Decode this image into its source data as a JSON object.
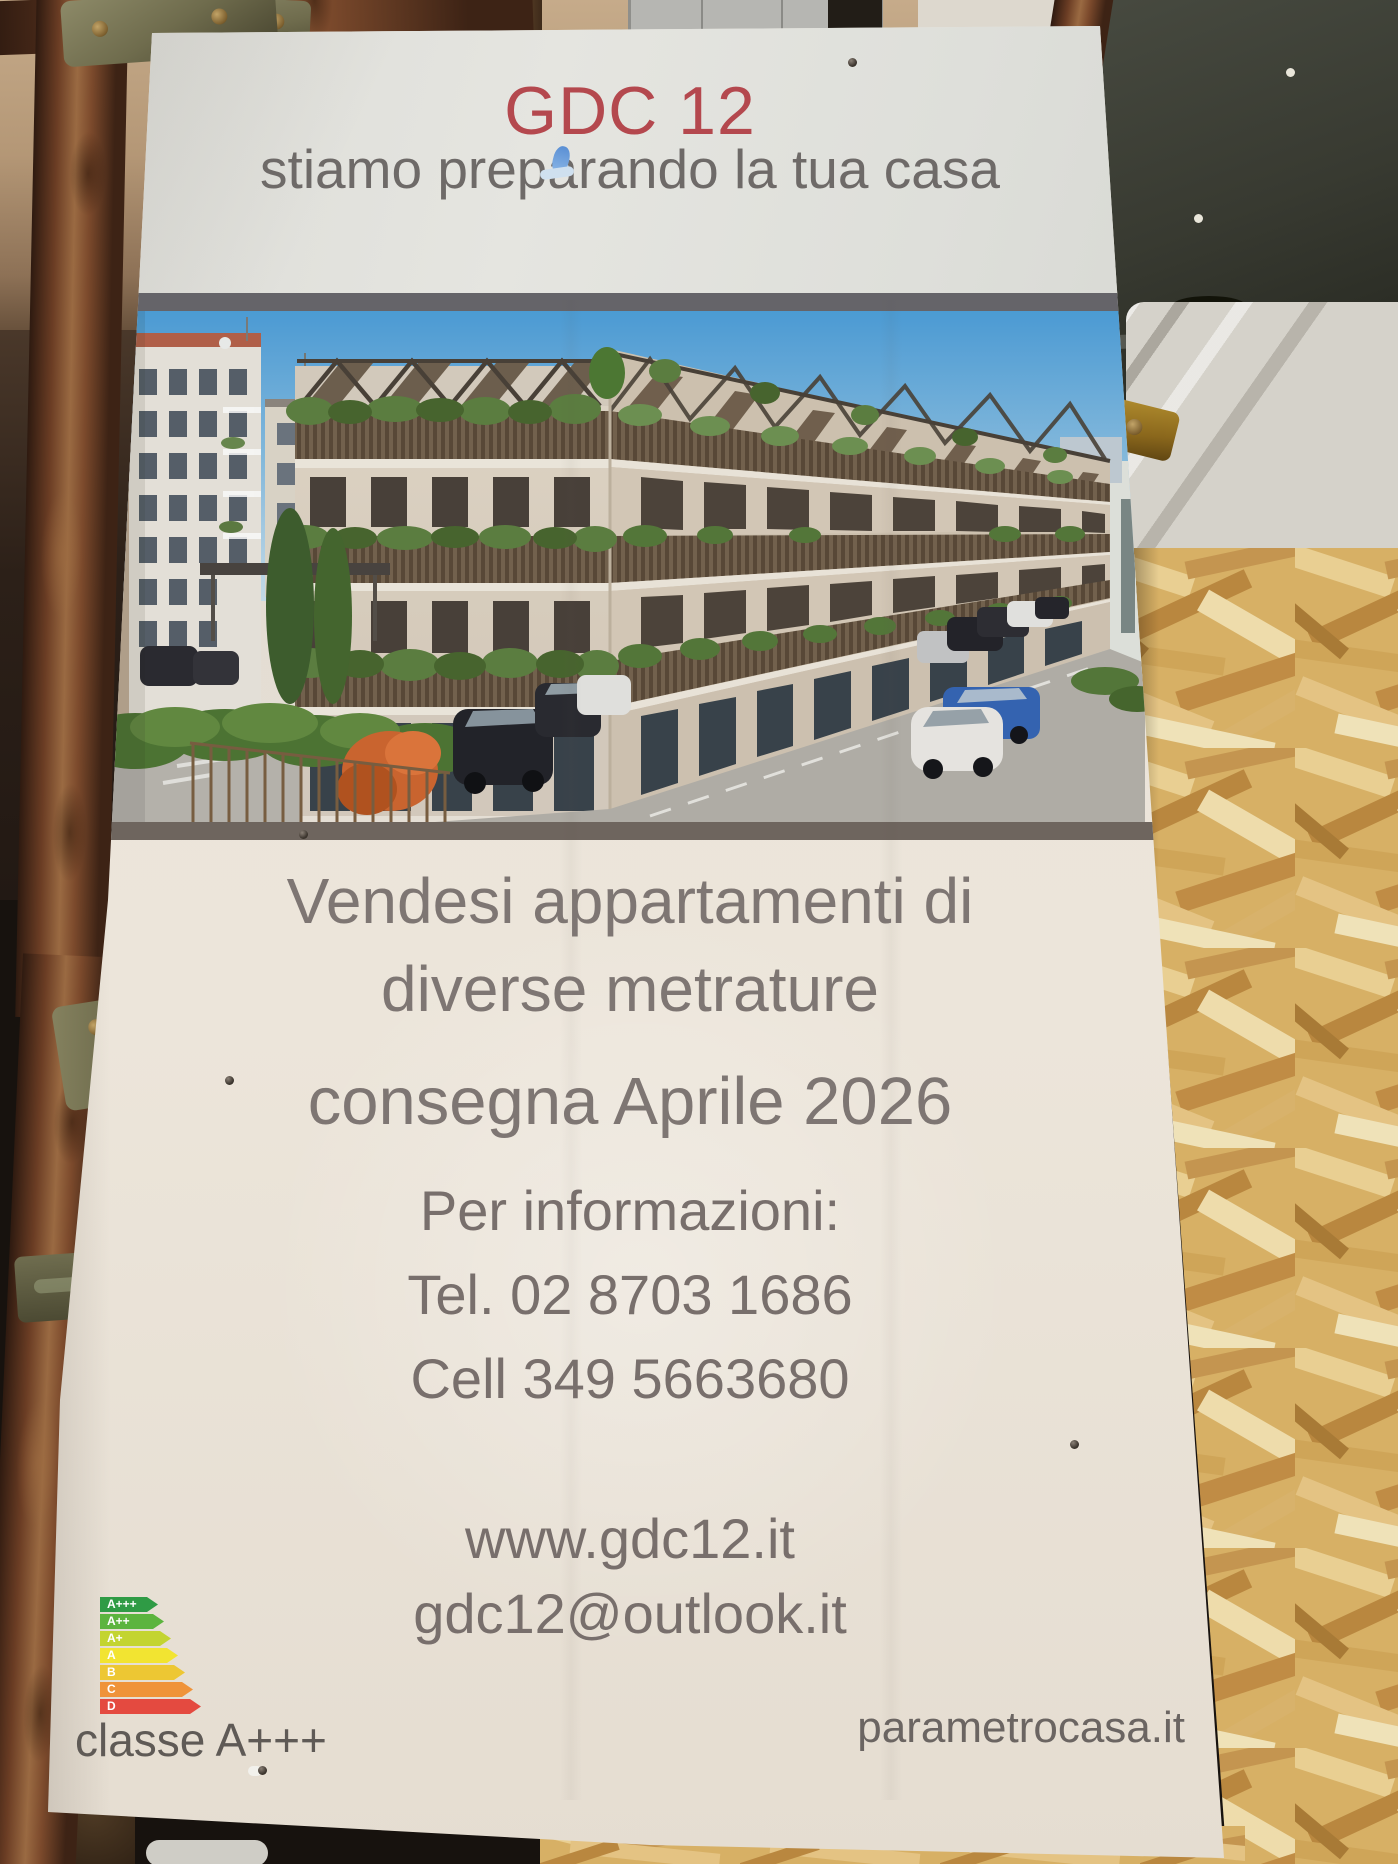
{
  "sign": {
    "title": "GDC 12",
    "subtitle": "stiamo preparando la tua casa",
    "sale_line1": "Vendesi appartamenti di",
    "sale_line2": "diverse metrature",
    "delivery": "consegna Aprile 2026",
    "info_label": "Per informazioni:",
    "phone": "Tel. 02 8703 1686",
    "mobile": "Cell 349 5663680",
    "website": "www.gdc12.it",
    "email": "gdc12@outlook.it",
    "energy_class_label": "classe A+++",
    "agency": "parametrocasa.it",
    "colors": {
      "title_red": "#b4484e",
      "text_gray": "#7b7370",
      "panel_top": "#e0e0db",
      "panel_bottom": "#e9e2d7",
      "divider_top": "#656469",
      "divider_bottom": "#6e655e"
    },
    "energy_scale": [
      {
        "label": "A+++",
        "color": "#2f9b45",
        "width": 58
      },
      {
        "label": "A++",
        "color": "#5cb43e",
        "width": 64
      },
      {
        "label": "A+",
        "color": "#c3d430",
        "width": 71
      },
      {
        "label": "A",
        "color": "#f2e431",
        "width": 78
      },
      {
        "label": "B",
        "color": "#edc733",
        "width": 85
      },
      {
        "label": "C",
        "color": "#ef9339",
        "width": 93
      },
      {
        "label": "D",
        "color": "#e44a40",
        "width": 101
      }
    ]
  },
  "scene": {
    "osb_wood": "#d7b065",
    "scaffold_rust": "#7c4a2c",
    "metal_panel": "#3c3e36",
    "tarp_white": "#d5d2ca",
    "render_sky": "#4d9fd9",
    "render_facade": "#ddd3c4",
    "render_greenery": "#5d8142",
    "render_street": "#b4b1aa",
    "render_accent_tree": "#d4652e",
    "render_car_blue": "#3566b5"
  }
}
